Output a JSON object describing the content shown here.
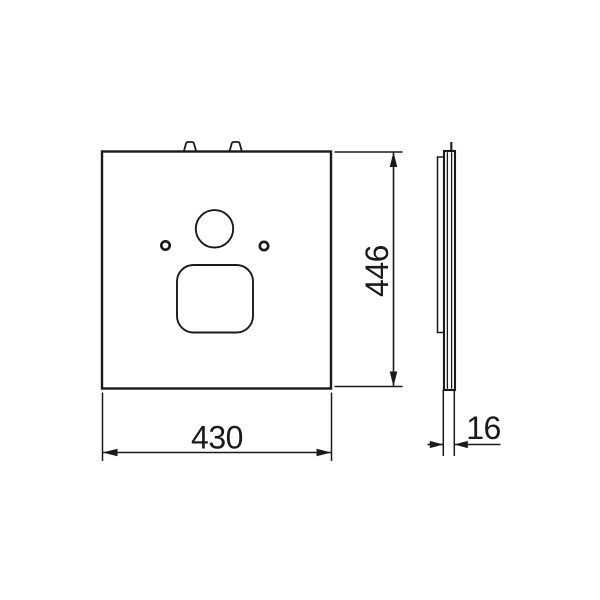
{
  "diagram": {
    "labels": {
      "width": "430",
      "height": "446",
      "thickness": "16"
    },
    "colors": {
      "line": "#1a1a1a",
      "background": "#ffffff"
    }
  }
}
